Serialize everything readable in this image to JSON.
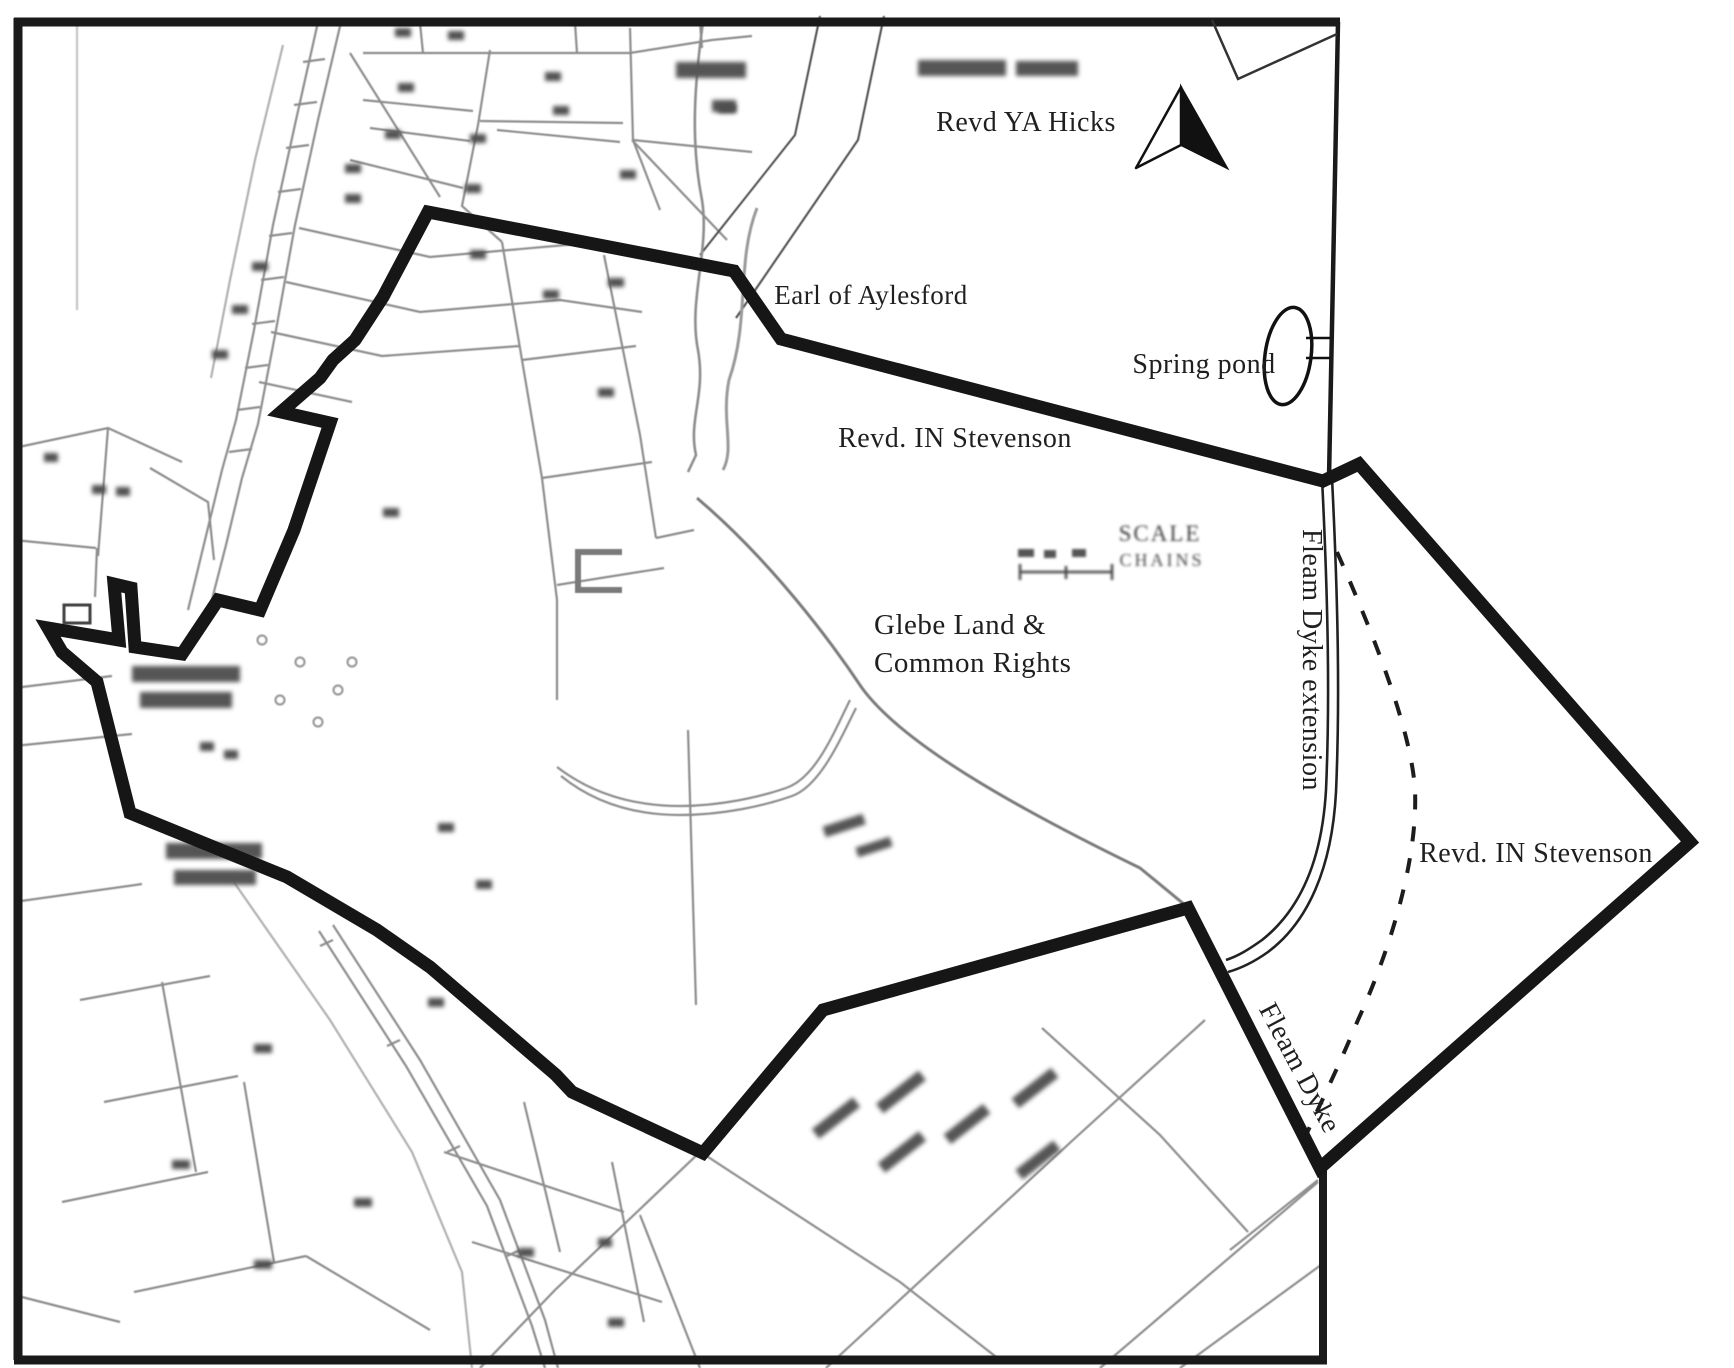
{
  "document": {
    "kind": "historical-parish-map",
    "description_visible_features": "scanned cadastral map with hand-drawn land boundary, owner labels, north arrow, scale bar"
  },
  "colors": {
    "background": "#ffffff",
    "boundary": "#161616",
    "map_frame": "#1a1a1a",
    "faded_map_lines": "#8d8d8d",
    "label_text": "#1f1f1f",
    "smudge": "#555555"
  },
  "labels": {
    "revd_ya_hicks": "Revd YA Hicks",
    "earl_of_aylesford": "Earl of Aylesford",
    "spring_pond": "Spring pond",
    "revd_in_stevenson_middle": "Revd. IN Stevenson",
    "glebe_land_line1": "Glebe Land &",
    "glebe_land_line2": "Common Rights",
    "fleam_dyke_extension": "Fleam Dyke extension",
    "revd_in_stevenson_right": "Revd. IN Stevenson",
    "fleam_dyke": "Fleam Dyke",
    "scale_heading": "SCALE",
    "scale_units": "CHAINS"
  }
}
